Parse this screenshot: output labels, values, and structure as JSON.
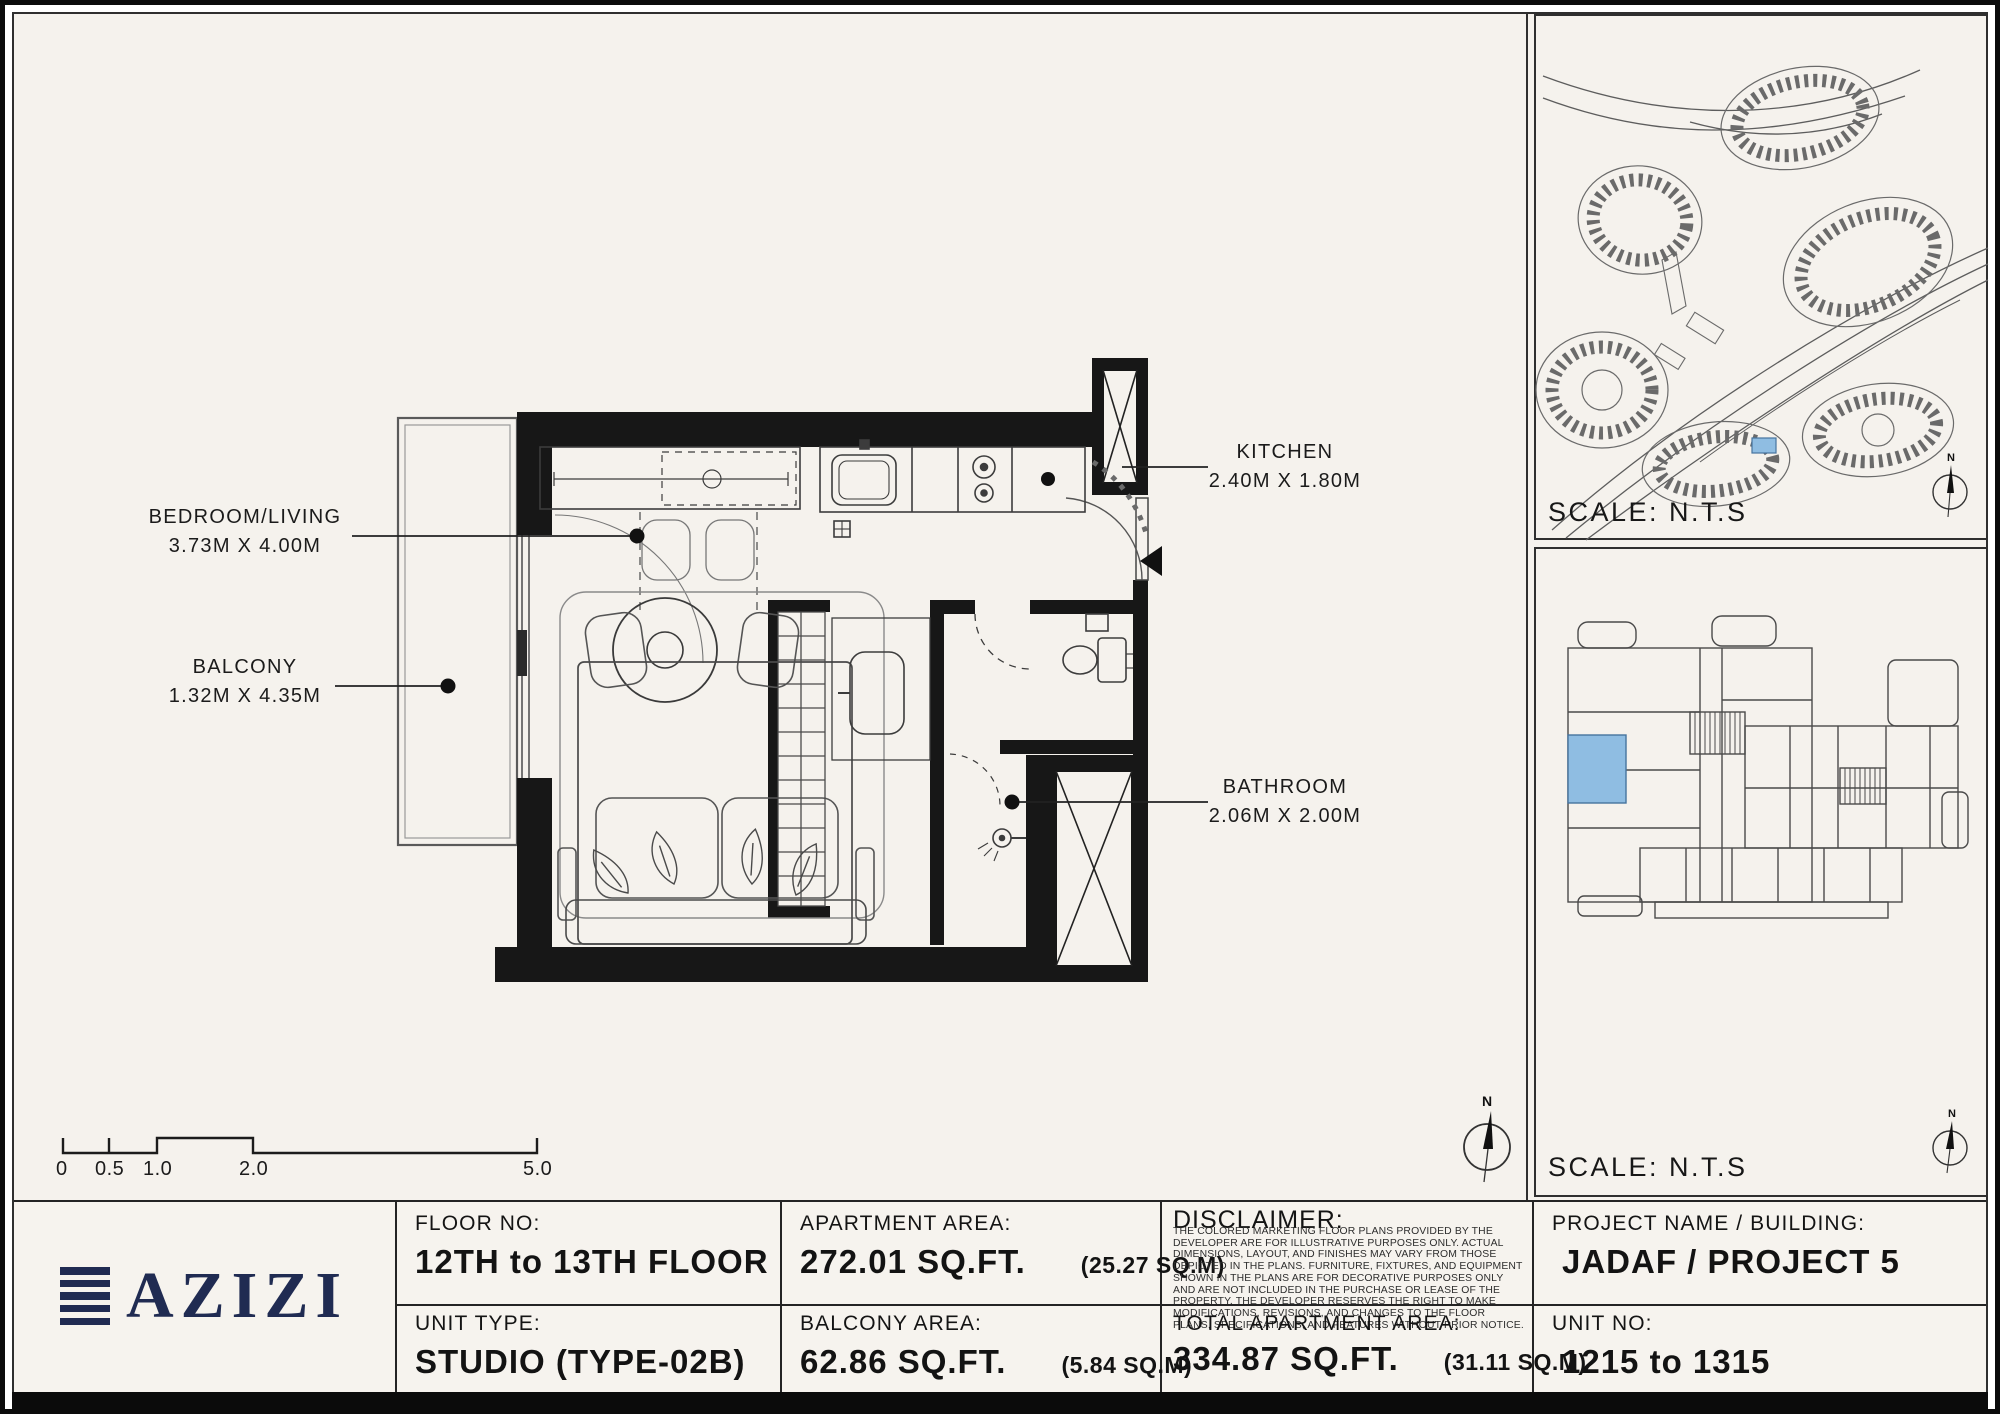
{
  "colors": {
    "paper": "#f5f2ed",
    "ink": "#161616",
    "navy": "#202b52",
    "unit_highlight": "#8fbde2"
  },
  "plan": {
    "labels": {
      "bedroom": {
        "name": "BEDROOM/LIVING",
        "dims": "3.73M X 4.00M"
      },
      "balcony": {
        "name": "BALCONY",
        "dims": "1.32M X 4.35M"
      },
      "kitchen": {
        "name": "KITCHEN",
        "dims": "2.40M X 1.80M"
      },
      "bathroom": {
        "name": "BATHROOM",
        "dims": "2.06M X 2.00M"
      }
    },
    "scale_bar": {
      "ticks": [
        "0",
        "0.5",
        "1.0",
        "2.0",
        "5.0"
      ]
    },
    "compass_label": "N"
  },
  "panels": {
    "site_map": {
      "scale_label": "SCALE: N.T.S",
      "compass_label": "N"
    },
    "key_plan": {
      "scale_label": "SCALE: N.T.S",
      "compass_label": "N"
    }
  },
  "table": {
    "floor": {
      "label": "FLOOR NO:",
      "value": "12TH to 13TH FLOOR"
    },
    "unit_type": {
      "label": "UNIT TYPE:",
      "value": "STUDIO (TYPE-02B)"
    },
    "apartment_area": {
      "label": "APARTMENT AREA:",
      "value": "272.01 SQ.FT.",
      "metric": "(25.27 SQ.M)"
    },
    "balcony_area": {
      "label": "BALCONY AREA:",
      "value": "62.86 SQ.FT.",
      "metric": "(5.84 SQ.M)"
    },
    "disclaimer": {
      "label": "DISCLAIMER:",
      "body": "THE COLORED MARKETING FLOOR PLANS PROVIDED BY THE DEVELOPER ARE FOR ILLUSTRATIVE PURPOSES ONLY. ACTUAL DIMENSIONS, LAYOUT, AND FINISHES MAY VARY FROM THOSE DEPICTED IN THE PLANS. FURNITURE, FIXTURES, AND EQUIPMENT SHOWN IN THE PLANS ARE FOR DECORATIVE PURPOSES ONLY AND ARE NOT INCLUDED IN THE PURCHASE OR LEASE OF THE PROPERTY. THE DEVELOPER RESERVES THE RIGHT TO MAKE MODIFICATIONS, REVISIONS, AND CHANGES TO THE FLOOR PLANS, SPECIFICATIONS, AND FEATURES WITHOUT PRIOR NOTICE."
    },
    "total_area": {
      "label": "TOTAL APARTMENT AREA:",
      "value": "334.87 SQ.FT.",
      "metric": "(31.11 SQ.M)"
    },
    "project": {
      "label": "PROJECT NAME / BUILDING:",
      "value": "JADAF / PROJECT 5"
    },
    "unit_no": {
      "label": "UNIT NO:",
      "value": "1215 to 1315"
    }
  },
  "brand": {
    "logo_text": "AZIZI"
  }
}
